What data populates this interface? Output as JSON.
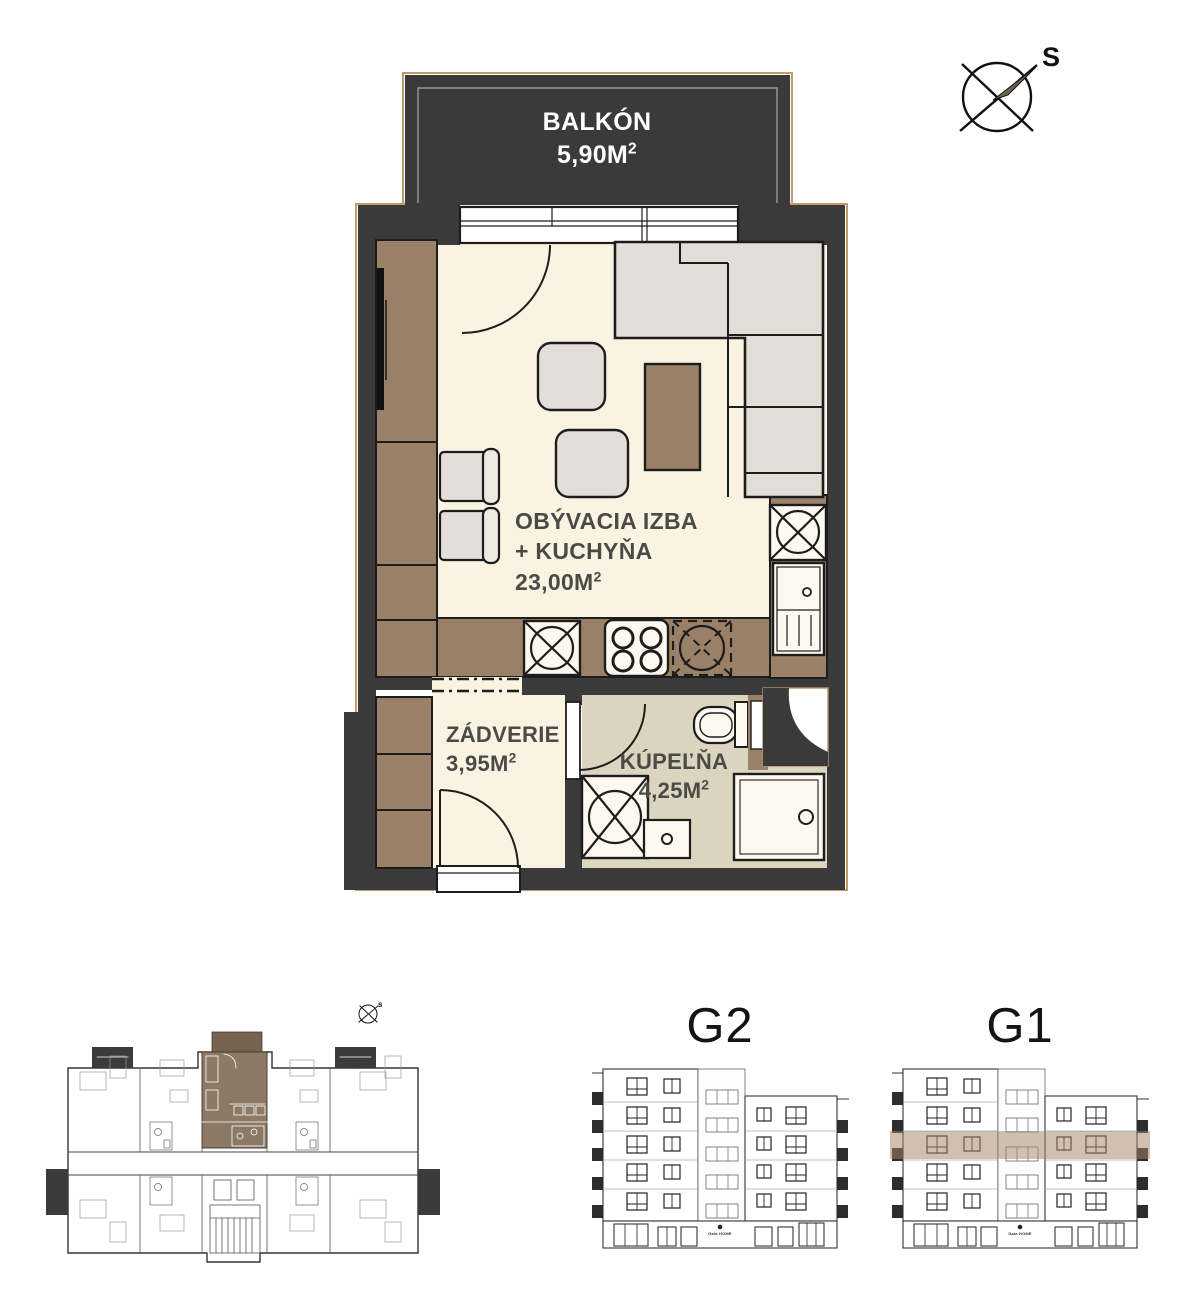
{
  "drawing_type": "apartment floor plan",
  "compass": {
    "label": "S"
  },
  "mini_plan": {
    "compass_label": "s"
  },
  "rooms": {
    "balkon": {
      "label": "BALKÓN",
      "area": "5,90M",
      "sup": "2"
    },
    "living": {
      "label_line1": "OBÝVACIA IZBA",
      "label_line2": "+ KUCHYŇA",
      "area": "23,00M",
      "sup": "2"
    },
    "zadverie": {
      "label": "ZÁDVERIE",
      "area": "3,95M",
      "sup": "2"
    },
    "kupelna": {
      "label": "KÚPEĽŇA",
      "area": "4,25M",
      "sup": "2"
    }
  },
  "elevations": {
    "g2": {
      "title": "G2",
      "logo": "Gala HOME"
    },
    "g1": {
      "title": "G1",
      "logo": "Gala HOME"
    }
  },
  "colors": {
    "wall": "#3a3a3a",
    "floor_cream": "#fbf3e1",
    "floor_bath": "#dbd4bf",
    "furniture_brown": "#9a8066",
    "furniture_gray": "#e4ded8",
    "accent_tan": "#c49a6b",
    "highlight_band": "rgba(163,135,108,0.52)",
    "mini_unit_brown": "#8d7a66",
    "mini_unit_balcony_brown": "#75634f"
  }
}
